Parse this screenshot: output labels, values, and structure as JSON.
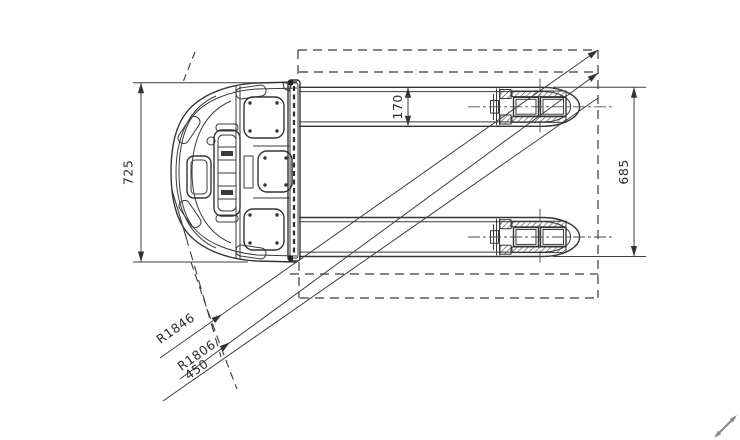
{
  "labels": {
    "overall_width": "725",
    "fork_outer_width": "170",
    "fork_span": "685",
    "turning_radius_outer": "R1846",
    "turning_radius_inner": "R1806",
    "offset": "450"
  },
  "colors": {
    "line": "#3a3a3a",
    "background": "#ffffff",
    "cursor": "#8a8a8a"
  }
}
